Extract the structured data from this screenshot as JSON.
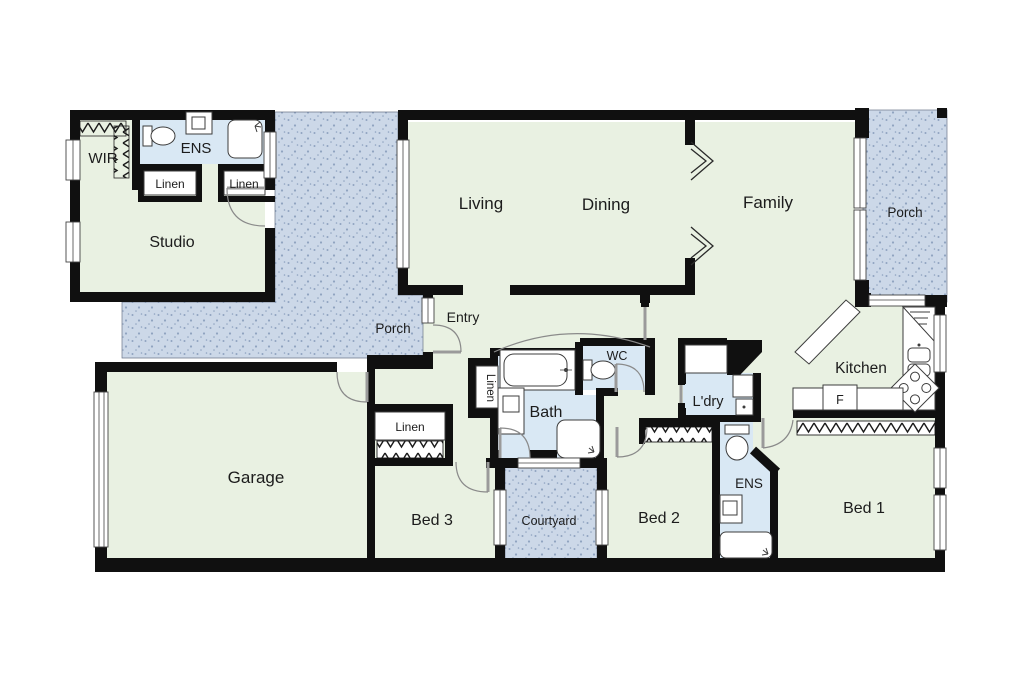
{
  "colors": {
    "wall": "#101010",
    "room": "#e9f1e2",
    "wet": "#d9e8f4",
    "outdoor": "#ccd8e8",
    "outdoor-dot": "#8fa3c0",
    "ink": "#1c1c1c"
  },
  "rooms": {
    "wir": "WIR",
    "studio_ens": "ENS",
    "studio_linen_left": "Linen",
    "studio_linen_right": "Linen",
    "studio": "Studio",
    "living": "Living",
    "dining": "Dining",
    "family": "Family",
    "porch_right": "Porch",
    "porch_central": "Porch",
    "entry": "Entry",
    "hall_linen": "Linen",
    "wc": "WC",
    "bath": "Bath",
    "laundry": "L'dry",
    "kitchen": "Kitchen",
    "fridge": "F",
    "bed3_linen": "Linen",
    "garage": "Garage",
    "bed3": "Bed 3",
    "courtyard": "Courtyard",
    "bed2": "Bed 2",
    "rear_ens": "ENS",
    "bed1": "Bed 1"
  }
}
